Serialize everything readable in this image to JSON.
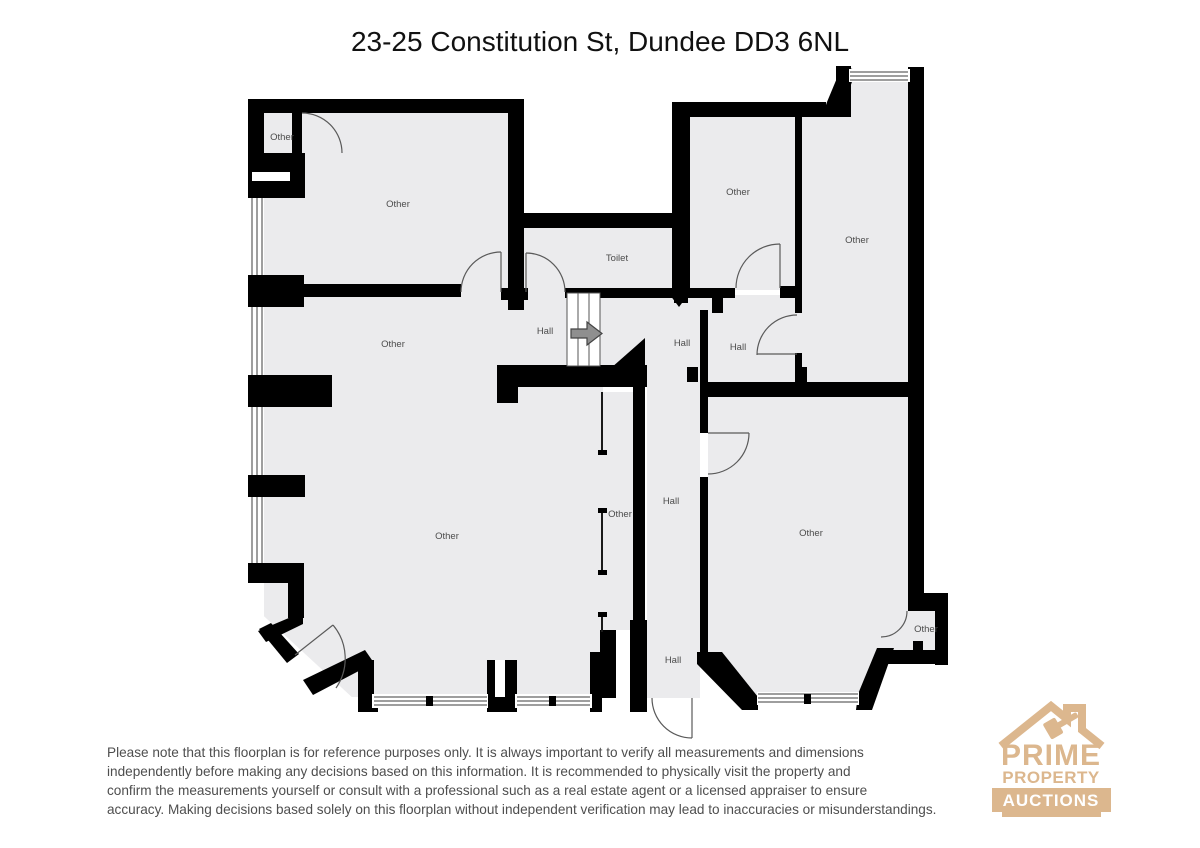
{
  "title": "23-25 Constitution St, Dundee DD3 6NL",
  "rooms": [
    {
      "label": "Other"
    },
    {
      "label": "Other"
    },
    {
      "label": "Toilet"
    },
    {
      "label": "Other"
    },
    {
      "label": "Other"
    },
    {
      "label": "Hall"
    },
    {
      "label": "Hall"
    },
    {
      "label": "Hall"
    },
    {
      "label": "Other"
    },
    {
      "label": "Other"
    },
    {
      "label": "Other"
    },
    {
      "label": "Hall"
    },
    {
      "label": "Other"
    },
    {
      "label": "Hall"
    },
    {
      "label": "Other"
    }
  ],
  "disclaimer": {
    "line1": "Please note that this floorplan is for reference purposes only. It is always important to verify all measurements and dimensions",
    "line2": "independently before making any decisions based on this information. It is recommended to physically visit the property and",
    "line3": "confirm the measurements yourself or consult with a professional such as a real estate agent or a licensed appraiser to ensure",
    "line4": "accuracy. Making decisions based solely on this floorplan without independent verification may lead to inaccuracies or misunderstandings."
  },
  "logo": {
    "line1": "PRIME",
    "line2": "PROPERTY",
    "line3": "AUCTIONS"
  },
  "colors": {
    "wall": "#000000",
    "floor": "#ebebed",
    "label_text": "#4c4c4c",
    "arrow_fill": "#8f8f8f",
    "logo_tan": "#dcb78e"
  }
}
